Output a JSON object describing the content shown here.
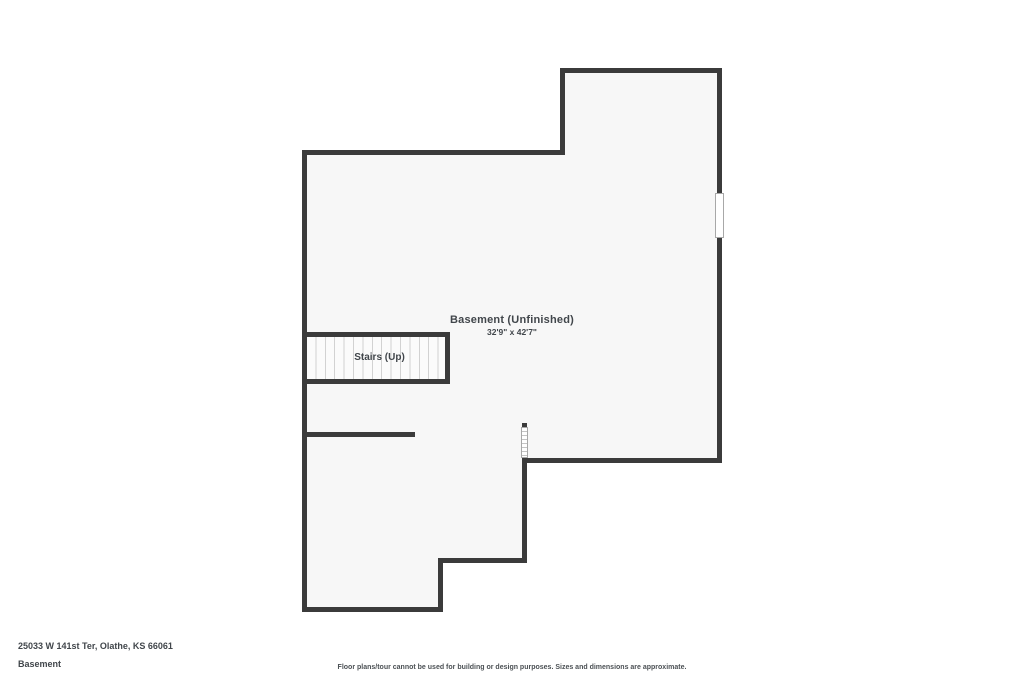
{
  "page": {
    "title": "Basement Floor Plan"
  },
  "floor_plan": {
    "room_label": "Basement (Unfinished)",
    "room_dimensions": "32'9\" x 42'7\"",
    "stairs_label": "Stairs (Up)",
    "features": [
      "exterior walls",
      "window on right wall",
      "hatched window/opening in interior wall",
      "stairs with treads",
      "interior wall stub"
    ]
  },
  "footer": {
    "address": "25033 W 141st Ter, Olathe, KS 66061",
    "floor_name": "Basement",
    "disclaimer": "Floor plans/tour cannot be used for building or design purposes. Sizes and dimensions are approximate."
  },
  "colors": {
    "wall": "#3b3b3b",
    "floor": "#f7f7f7",
    "text": "#41464b",
    "background": "#ffffff",
    "window_border": "#a8a8a8",
    "tread_line": "#d2d2d2"
  }
}
